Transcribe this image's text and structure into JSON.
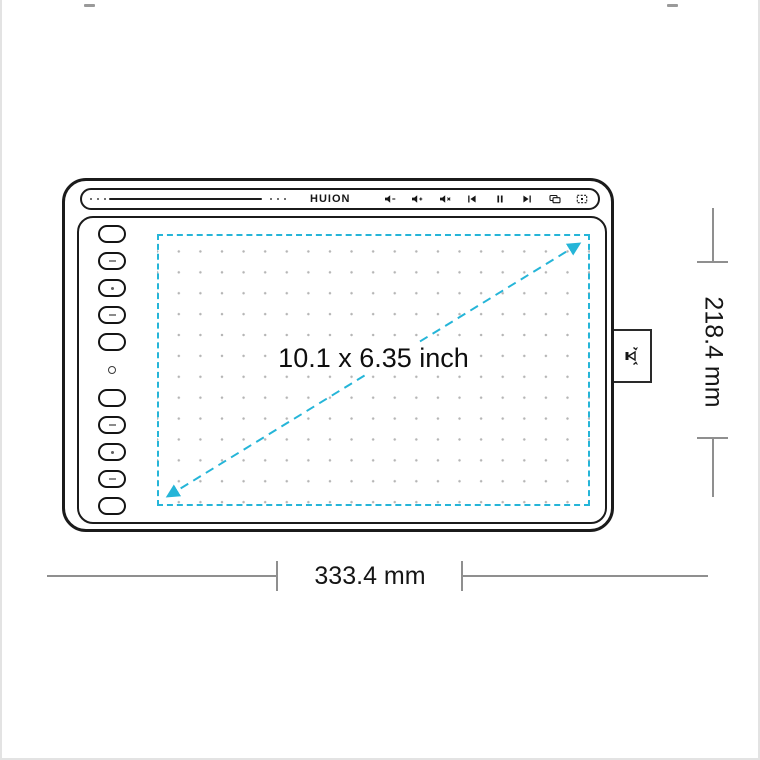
{
  "colors": {
    "accent": "#25b5d8",
    "outline": "#1b1b1b",
    "dimension_line": "#8f8f8f",
    "grid_dot": "#b5b5b5"
  },
  "brand": {
    "logo": "HUION"
  },
  "media_bar": {
    "keys": [
      "volume-down",
      "volume-up",
      "mute",
      "previous-track",
      "play-pause",
      "next-track",
      "switch-display",
      "virtual-desktop"
    ]
  },
  "express_keys": {
    "marks": [
      "none",
      "minus",
      "dot",
      "minus",
      "none",
      "none",
      "minus",
      "dot",
      "minus",
      "none"
    ]
  },
  "active_area": {
    "label": "10.1 x 6.35 inch"
  },
  "dimensions": {
    "width_label": "333.4 mm",
    "height_label": "218.4 mm"
  }
}
